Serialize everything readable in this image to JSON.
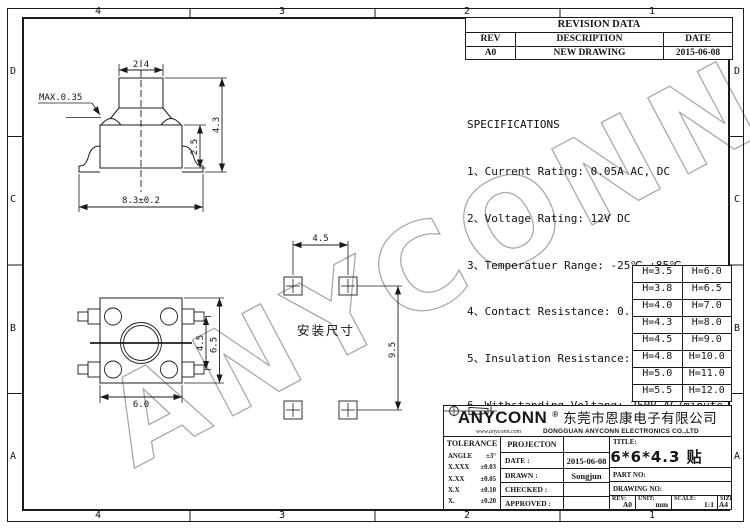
{
  "sheet": {
    "zones_h": [
      "4",
      "3",
      "2",
      "1"
    ],
    "zones_v": [
      "D",
      "C",
      "B",
      "A"
    ]
  },
  "watermark": "ANYCONN",
  "revision_table": {
    "title": "REVISION DATA",
    "headers": [
      "REV",
      "DESCRIPTION",
      "DATE"
    ],
    "rows": [
      [
        "A0",
        "NEW DRAWING",
        "2015-06-08"
      ]
    ]
  },
  "specifications": {
    "title": "SPECIFICATIONS",
    "items": [
      "1、Current Rating: 0.05A AC, DC",
      "2、Voltage Rating: 12V DC",
      "3、Temperatuer Range: -25℃~+85℃",
      "4、Contact Resistance: 0.1Ω Max",
      "5、Insulation Resistance: 100mΩ Min",
      "6、Withstanding Voltang: 250V AC/minute"
    ]
  },
  "height_table": {
    "rows": [
      [
        "H=3.5",
        "H=6.0"
      ],
      [
        "H=3.8",
        "H=6.5"
      ],
      [
        "H=4.0",
        "H=7.0"
      ],
      [
        "H=4.3",
        "H=8.0"
      ],
      [
        "H=4.5",
        "H=9.0"
      ],
      [
        "H=4.8",
        "H=10.0"
      ],
      [
        "H=5.0",
        "H=11.0"
      ],
      [
        "H=5.5",
        "H=12.0"
      ]
    ]
  },
  "drawing": {
    "pad_layout_label": "安装尺寸",
    "dims": {
      "fv_width": "2.4",
      "fv_dome": "MAX.0.35",
      "fv_total": "4.3",
      "fv_body": "2.5",
      "fv_span": "8.3±0.2",
      "pv_width": "6.0",
      "pv_pitch": "4.5",
      "pv_height": "6.5",
      "pad_pitch": "4.5",
      "pad_span": "9.5"
    }
  },
  "title_block": {
    "logo": "ANYCONN",
    "registered": "®",
    "company_cn": "东莞市恩康电子有限公司",
    "website": "www.anyconn.com",
    "company_en": "DONGGUAN ANYCONN ELECTRONICS CO.,LTD",
    "tolerance": {
      "title": "TOLERANCE",
      "rows": [
        [
          "ANGLE",
          "±3°"
        ],
        [
          "X.XXX",
          "±0.03"
        ],
        [
          "X.XX",
          "±0.05"
        ],
        [
          "X.X",
          "±0.10"
        ],
        [
          "X.",
          "±0.20"
        ]
      ]
    },
    "projection_label": "PROJECTON",
    "date_label": "DATE :",
    "date": "2015-06-08",
    "drawn_label": "DRAWN :",
    "drawn": "Songjun",
    "checked_label": "CHECKED :",
    "approved_label": "APPROVED :",
    "title_label": "TITLE:",
    "title": "6*6*4.3 贴片",
    "part_no_label": "PART NO:",
    "drawing_no_label": "DRAWING NO:",
    "rev_label": "REV:",
    "rev": "A0",
    "unit_label": "UNIT:",
    "unit": "mm",
    "scale_label": "SCALE:",
    "scale": "1:1",
    "size_label": "SIZE:",
    "size": "A4"
  }
}
